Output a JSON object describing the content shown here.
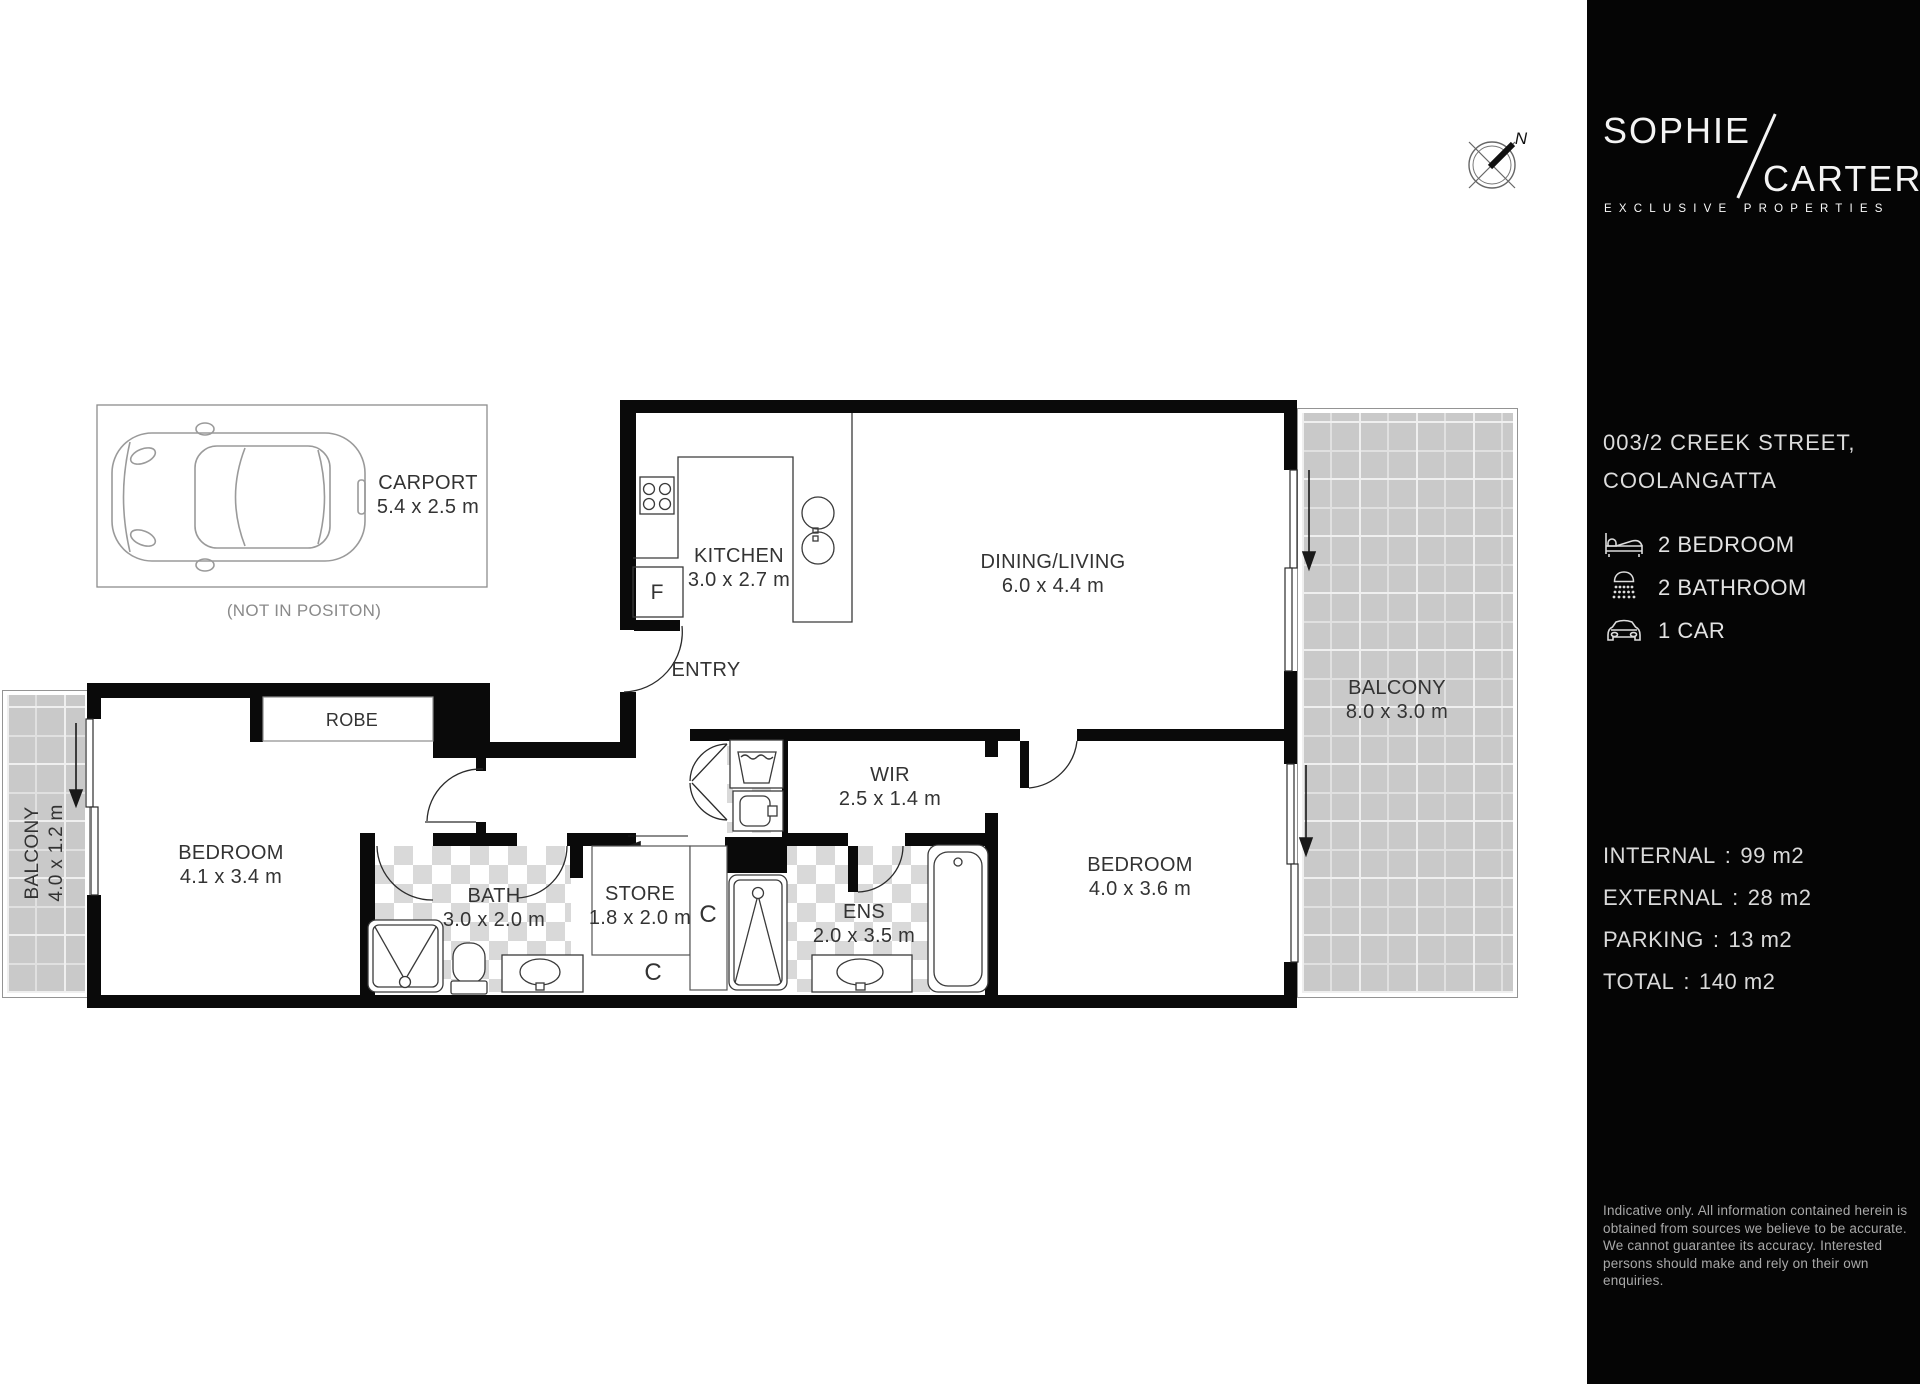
{
  "colors": {
    "sidebar_bg": "#050505",
    "plan_bg": "#ffffff",
    "wall": "#0a0a0a",
    "label_text": "#333333",
    "muted_text": "#8a8a8a",
    "tile": "#c9c9c9",
    "checker": "#d9d9d9",
    "sidebar_text": "#dadada"
  },
  "compass": {
    "north_label": "N"
  },
  "plan": {
    "carport": {
      "name": "CARPORT",
      "dims": "5.4 x 2.5 m",
      "note": "(NOT IN POSITON)"
    },
    "rooms": [
      {
        "id": "kitchen",
        "name": "KITCHEN",
        "dims": "3.0 x 2.7 m"
      },
      {
        "id": "dining-living",
        "name": "DINING/LIVING",
        "dims": "6.0 x 4.4 m"
      },
      {
        "id": "entry",
        "name": "ENTRY",
        "dims": ""
      },
      {
        "id": "robe",
        "name": "ROBE",
        "dims": ""
      },
      {
        "id": "balcony-right",
        "name": "BALCONY",
        "dims": "8.0 x 3.0 m"
      },
      {
        "id": "balcony-left",
        "name": "BALCONY",
        "dims": "4.0 x 1.2 m"
      },
      {
        "id": "bedroom-1",
        "name": "BEDROOM",
        "dims": "4.1 x 3.4 m"
      },
      {
        "id": "bath",
        "name": "BATH",
        "dims": "3.0 x 2.0 m"
      },
      {
        "id": "store",
        "name": "STORE",
        "dims": "1.8 x 2.0 m"
      },
      {
        "id": "wir",
        "name": "WIR",
        "dims": "2.5 x 1.4 m"
      },
      {
        "id": "ens",
        "name": "ENS",
        "dims": "2.0 x 3.5 m"
      },
      {
        "id": "bedroom-2",
        "name": "BEDROOM",
        "dims": "4.0 x 3.6 m"
      }
    ],
    "closet_label": "C",
    "fridge_label": "F"
  },
  "sidebar": {
    "logo": {
      "line1": "SOPHIE",
      "line2": "CARTER",
      "tagline": "EXCLUSIVE PROPERTIES"
    },
    "address_line1": "003/2 CREEK STREET,",
    "address_line2": "COOLANGATTA",
    "features": [
      {
        "icon": "bed-icon",
        "label": "2 BEDROOM"
      },
      {
        "icon": "shower-icon",
        "label": "2 BATHROOM"
      },
      {
        "icon": "car-icon",
        "label": "1 CAR"
      }
    ],
    "separator": ":",
    "areas": [
      {
        "label": "INTERNAL",
        "value": "99 m2"
      },
      {
        "label": "EXTERNAL",
        "value": "28 m2"
      },
      {
        "label": "PARKING",
        "value": "13 m2"
      },
      {
        "label": "TOTAL",
        "value": "140 m2"
      }
    ],
    "disclaimer": "Indicative only. All information contained herein is obtained from sources we believe to be accurate. We cannot guarantee its accuracy. Interested persons should make and rely on their own enquiries."
  }
}
